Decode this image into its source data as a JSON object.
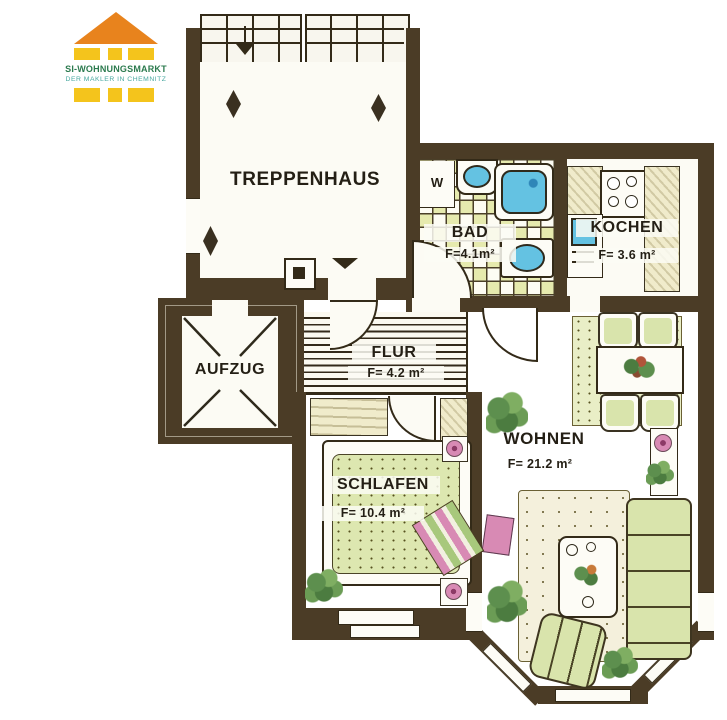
{
  "logo": {
    "brand": "SI-WOHNUNGSMARKT",
    "tagline": "DER MAKLER IN CHEMNITZ",
    "colors": {
      "roof": "#E8831D",
      "blocks": "#F4C41C",
      "brand_text": "#2B7A4E",
      "tagline_text": "#49A8A0"
    }
  },
  "rooms": {
    "treppenhaus": {
      "label": "TREPPENHAUS"
    },
    "aufzug": {
      "label": "AUFZUG"
    },
    "bad": {
      "label": "BAD",
      "area": "F=4.1m²"
    },
    "kochen": {
      "label": "KOCHEN",
      "area": "F= 3.6 m²"
    },
    "flur": {
      "label": "FLUR",
      "area": "F= 4.2 m²"
    },
    "wohnen": {
      "label": "WOHNEN",
      "area": "F= 21.2 m²"
    },
    "schlafen": {
      "label": "SCHLAFEN",
      "area": "F= 10.4 m²"
    }
  },
  "annotations": {
    "washer": "W"
  },
  "plan_colors": {
    "wall": "#4B3C26",
    "fixture_blue": "#64C2E2",
    "furniture_green": "#D9E4AC",
    "tile_yellow": "#E6EAAE",
    "accent_pink": "#D88AB4"
  }
}
